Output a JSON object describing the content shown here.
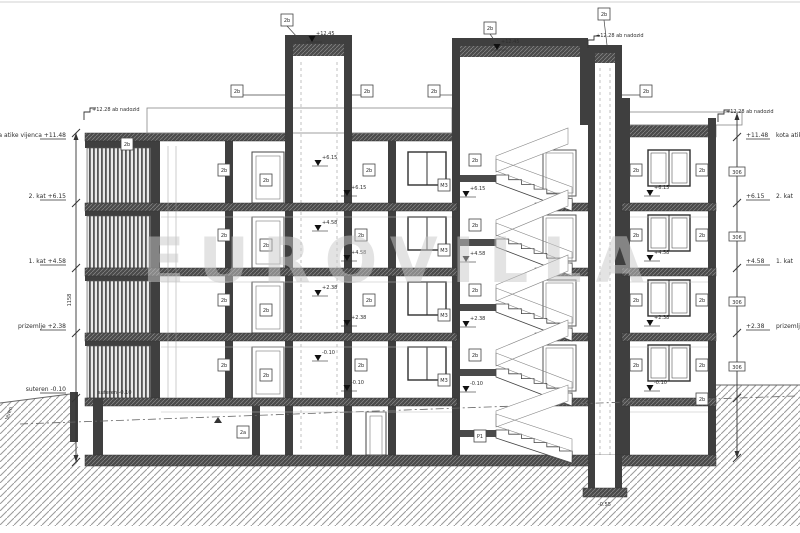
{
  "watermark": "EUROVILLA",
  "levels_left": [
    {
      "label": "kota atike vijenca",
      "value": "+11.48",
      "y": 137
    },
    {
      "label": "2. kat",
      "value": "+6.15",
      "y": 198
    },
    {
      "label": "1. kat",
      "value": "+4.58",
      "y": 263
    },
    {
      "label": "prizemlje",
      "value": "+2.38",
      "y": 328
    },
    {
      "label": "suteren",
      "value": "-0.10",
      "y": 391
    }
  ],
  "levels_right": [
    {
      "value": "+11.48",
      "label": "kota atike vijenca",
      "y": 137
    },
    {
      "value": "+6.15",
      "label": "2. kat",
      "y": 198
    },
    {
      "value": "+4.58",
      "label": "1. kat",
      "y": 263
    },
    {
      "value": "+2.38",
      "label": "prizemlje",
      "y": 328
    }
  ],
  "annotations": {
    "nadozid_left": "+12.28 ab nadozid",
    "nadozid_mid": "+12.28 ab nadozid",
    "nadozid_right": "+12.28 ab nadozid",
    "teren": "teren",
    "suteren": "suteren  -0.10",
    "pit_level": "-0.55",
    "overall_dim": "1158"
  },
  "ref_markers": [
    {
      "x": 287,
      "y": 20,
      "t": "2b"
    },
    {
      "x": 490,
      "y": 28,
      "t": "2b"
    },
    {
      "x": 604,
      "y": 14,
      "t": "2b"
    },
    {
      "x": 237,
      "y": 91,
      "t": "2b"
    },
    {
      "x": 367,
      "y": 91,
      "t": "2b"
    },
    {
      "x": 434,
      "y": 91,
      "t": "2b"
    },
    {
      "x": 646,
      "y": 91,
      "t": "2b"
    },
    {
      "x": 127,
      "y": 144,
      "t": "2b"
    },
    {
      "x": 224,
      "y": 170,
      "t": "2b"
    },
    {
      "x": 224,
      "y": 235,
      "t": "2b"
    },
    {
      "x": 224,
      "y": 300,
      "t": "2b"
    },
    {
      "x": 224,
      "y": 365,
      "t": "2b"
    },
    {
      "x": 266,
      "y": 180,
      "t": "2b"
    },
    {
      "x": 266,
      "y": 245,
      "t": "2b"
    },
    {
      "x": 266,
      "y": 310,
      "t": "2b"
    },
    {
      "x": 266,
      "y": 375,
      "t": "2b"
    },
    {
      "x": 369,
      "y": 170,
      "t": "2b"
    },
    {
      "x": 361,
      "y": 235,
      "t": "2b"
    },
    {
      "x": 369,
      "y": 300,
      "t": "2b"
    },
    {
      "x": 361,
      "y": 365,
      "t": "2b"
    },
    {
      "x": 444,
      "y": 185,
      "t": "M3"
    },
    {
      "x": 444,
      "y": 250,
      "t": "M3"
    },
    {
      "x": 444,
      "y": 315,
      "t": "M3"
    },
    {
      "x": 444,
      "y": 380,
      "t": "M3"
    },
    {
      "x": 475,
      "y": 160,
      "t": "2b"
    },
    {
      "x": 475,
      "y": 225,
      "t": "2b"
    },
    {
      "x": 475,
      "y": 290,
      "t": "2b"
    },
    {
      "x": 475,
      "y": 355,
      "t": "2b"
    },
    {
      "x": 636,
      "y": 170,
      "t": "2b"
    },
    {
      "x": 636,
      "y": 235,
      "t": "2b"
    },
    {
      "x": 636,
      "y": 300,
      "t": "2b"
    },
    {
      "x": 636,
      "y": 365,
      "t": "2b"
    },
    {
      "x": 702,
      "y": 170,
      "t": "2b"
    },
    {
      "x": 702,
      "y": 235,
      "t": "2b"
    },
    {
      "x": 702,
      "y": 300,
      "t": "2b"
    },
    {
      "x": 702,
      "y": 365,
      "t": "2b"
    },
    {
      "x": 243,
      "y": 432,
      "t": "2a"
    },
    {
      "x": 480,
      "y": 436,
      "t": "P1"
    },
    {
      "x": 702,
      "y": 399,
      "t": "2b"
    }
  ],
  "elev_markers": [
    {
      "x": 312,
      "y": 42,
      "v": "+12.45"
    },
    {
      "x": 497,
      "y": 50,
      "v": "+12.45"
    },
    {
      "x": 318,
      "y": 166,
      "v": "+6.15"
    },
    {
      "x": 318,
      "y": 231,
      "v": "+4.58"
    },
    {
      "x": 318,
      "y": 296,
      "v": "+2.38"
    },
    {
      "x": 318,
      "y": 361,
      "v": "-0.10"
    },
    {
      "x": 347,
      "y": 196,
      "v": "+6.15"
    },
    {
      "x": 347,
      "y": 261,
      "v": "+4.58"
    },
    {
      "x": 347,
      "y": 326,
      "v": "+2.38"
    },
    {
      "x": 347,
      "y": 391,
      "v": "-0.10"
    },
    {
      "x": 466,
      "y": 197,
      "v": "+6.15"
    },
    {
      "x": 466,
      "y": 262,
      "v": "+4.58"
    },
    {
      "x": 466,
      "y": 327,
      "v": "+2.38"
    },
    {
      "x": 466,
      "y": 392,
      "v": "-0.10"
    },
    {
      "x": 650,
      "y": 196,
      "v": "+6.15"
    },
    {
      "x": 650,
      "y": 261,
      "v": "+4.58"
    },
    {
      "x": 650,
      "y": 326,
      "v": "+2.38"
    },
    {
      "x": 650,
      "y": 391,
      "v": "-0.10"
    }
  ],
  "dim_boxes_right": [
    {
      "y": 172,
      "t": "306"
    },
    {
      "y": 237,
      "t": "306"
    },
    {
      "y": 302,
      "t": "306"
    },
    {
      "y": 367,
      "t": "306"
    }
  ],
  "colors": {
    "wall": "#3f3f3f",
    "slab": "#4a4a4a",
    "line": "#555555",
    "ground": "#9a9a9a",
    "watermark": "#c9c9c9"
  }
}
